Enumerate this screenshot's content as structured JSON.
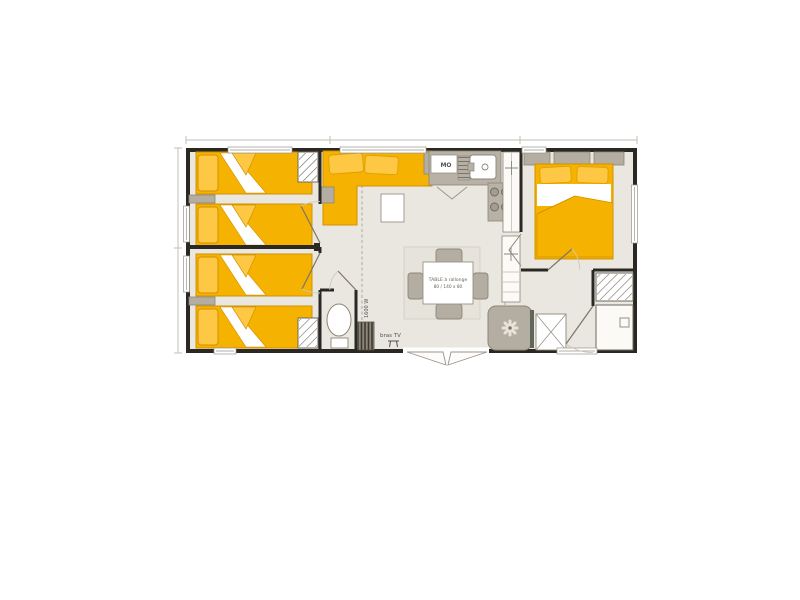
{
  "canvas": {
    "width": 800,
    "height": 600,
    "background": "#ffffff"
  },
  "floorplan": {
    "type": "mobile-home-floor-plan",
    "labels": {
      "microwave": "MO",
      "heater_power": "1600 W",
      "tv_bracket": "bras TV",
      "table_line1": "TABLE à rallonge",
      "table_line2": "80 / 140 x 80"
    },
    "colors": {
      "wall": "#2b2824",
      "floor": "#eae7e0",
      "furniture_yellow": "#f6b200",
      "furniture_yellow_light": "#ffc844",
      "furniture_gray": "#b3ada2",
      "counter_gray": "#b7b1a6",
      "outline_gray": "#8d8779",
      "dim_line": "#c4bfb5"
    },
    "rooms": [
      "bedroom-twin-1",
      "bedroom-twin-2",
      "living-area",
      "kitchen",
      "bedroom-double",
      "wc",
      "shower-room"
    ]
  }
}
